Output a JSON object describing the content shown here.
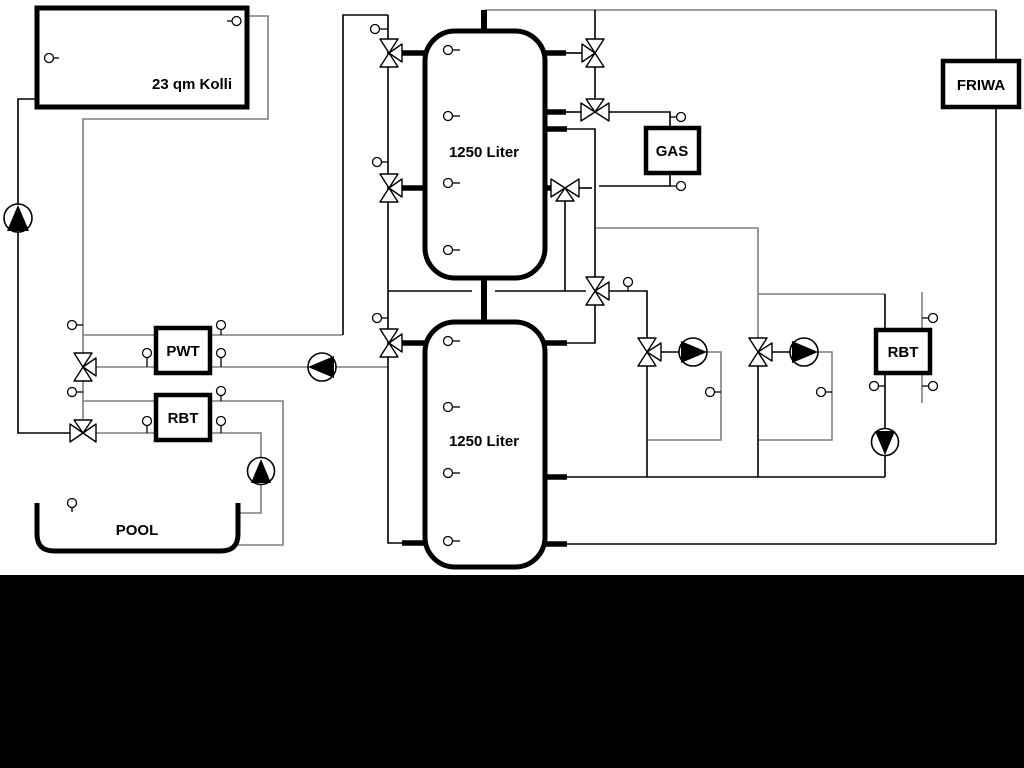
{
  "diagram": {
    "collector_label": "23 qm Kolli",
    "tank_top_label": "1250 Liter",
    "tank_bottom_label": "1250 Liter",
    "pwt_label": "PWT",
    "rbt_left_label": "RBT",
    "gas_label": "GAS",
    "friwa_label": "FRIWA",
    "rbt_right_label": "RBT",
    "pool_label": "POOL",
    "colors": {
      "line_gray": "#7f7f7f",
      "line_black": "#000000",
      "background": "#ffffff",
      "footer_band": "#000000"
    }
  }
}
